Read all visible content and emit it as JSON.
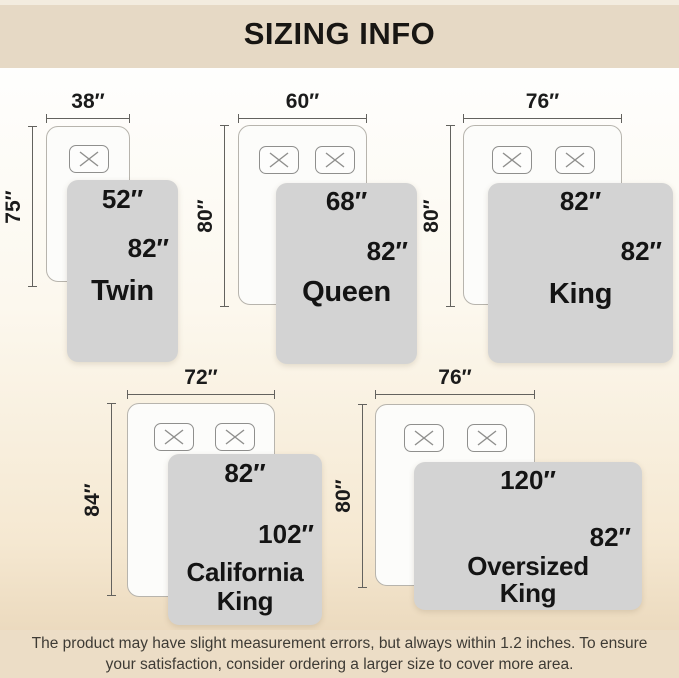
{
  "header": {
    "title": "SIZING INFO"
  },
  "sizes": [
    {
      "name": "Twin",
      "bed_width": "38″",
      "bed_length": "75″",
      "blanket_width": "52″",
      "blanket_length": "82″",
      "pillows": 1
    },
    {
      "name": "Queen",
      "bed_width": "60″",
      "bed_length": "80″",
      "blanket_width": "68″",
      "blanket_length": "82″",
      "pillows": 2
    },
    {
      "name": "King",
      "bed_width": "76″",
      "bed_length": "80″",
      "blanket_width": "82″",
      "blanket_length": "82″",
      "pillows": 2
    },
    {
      "name": "California King",
      "bed_width": "72″",
      "bed_length": "84″",
      "blanket_width": "82″",
      "blanket_length": "102″",
      "pillows": 2
    },
    {
      "name": "Oversized King",
      "bed_width": "76″",
      "bed_length": "80″",
      "blanket_width": "120″",
      "blanket_length": "82″",
      "pillows": 2
    }
  ],
  "footer": {
    "text": "The product may have slight measurement errors, but always within 1.2 inches. To ensure your satisfaction, consider ordering a larger size to cover more area."
  },
  "colors": {
    "band_bg": "#e6d9c5",
    "footer_bg": "#ecddc6",
    "blanket": "#d3d3d3",
    "bed": "#fcfcfa",
    "dimension_line": "#63625e",
    "label_text": "#1b1b1b"
  }
}
